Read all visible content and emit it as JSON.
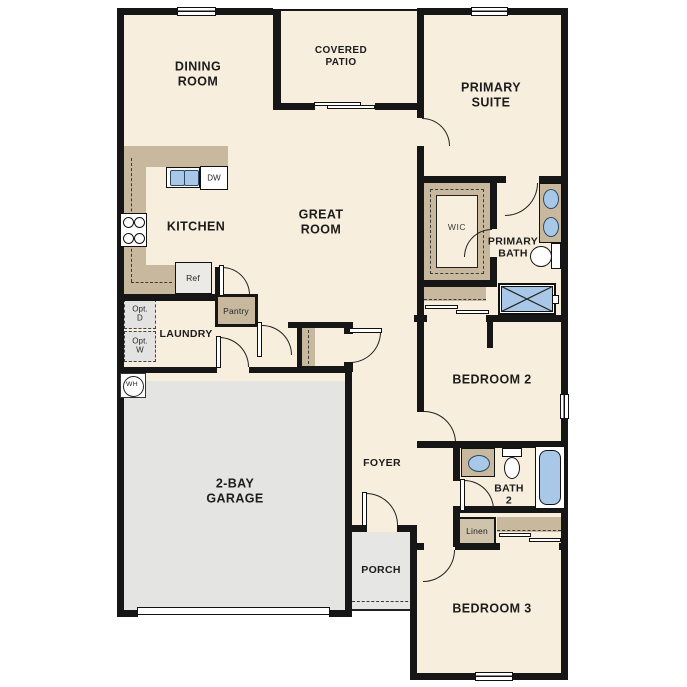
{
  "plan": {
    "title": "single-story floor plan",
    "rooms": {
      "dining_room": "DINING\nROOM",
      "covered_patio": "COVERED\nPATIO",
      "primary_suite": "PRIMARY\nSUITE",
      "kitchen": "KITCHEN",
      "great_room": "GREAT\nROOM",
      "wic": "WIC",
      "primary_bath": "PRIMARY\nBATH",
      "laundry": "LAUNDRY",
      "bedroom_2": "BEDROOM 2",
      "foyer": "FOYER",
      "bath_2": "BATH\n2",
      "porch": "PORCH",
      "bedroom_3": "BEDROOM 3",
      "garage": "2-BAY\nGARAGE"
    },
    "fixtures": {
      "dishwasher": "DW",
      "refrigerator": "Ref",
      "pantry": "Pantry",
      "opt_dryer": "Opt.\nD",
      "opt_washer": "Opt.\nW",
      "water_heater": "WH",
      "linen": "Linen"
    },
    "colors": {
      "floor": "#f7eede",
      "wall": "#161616",
      "casework": "#c7b89e",
      "concrete": "#e4e4e2",
      "plumbing_fixture_blue": "#a9c8e8"
    }
  }
}
